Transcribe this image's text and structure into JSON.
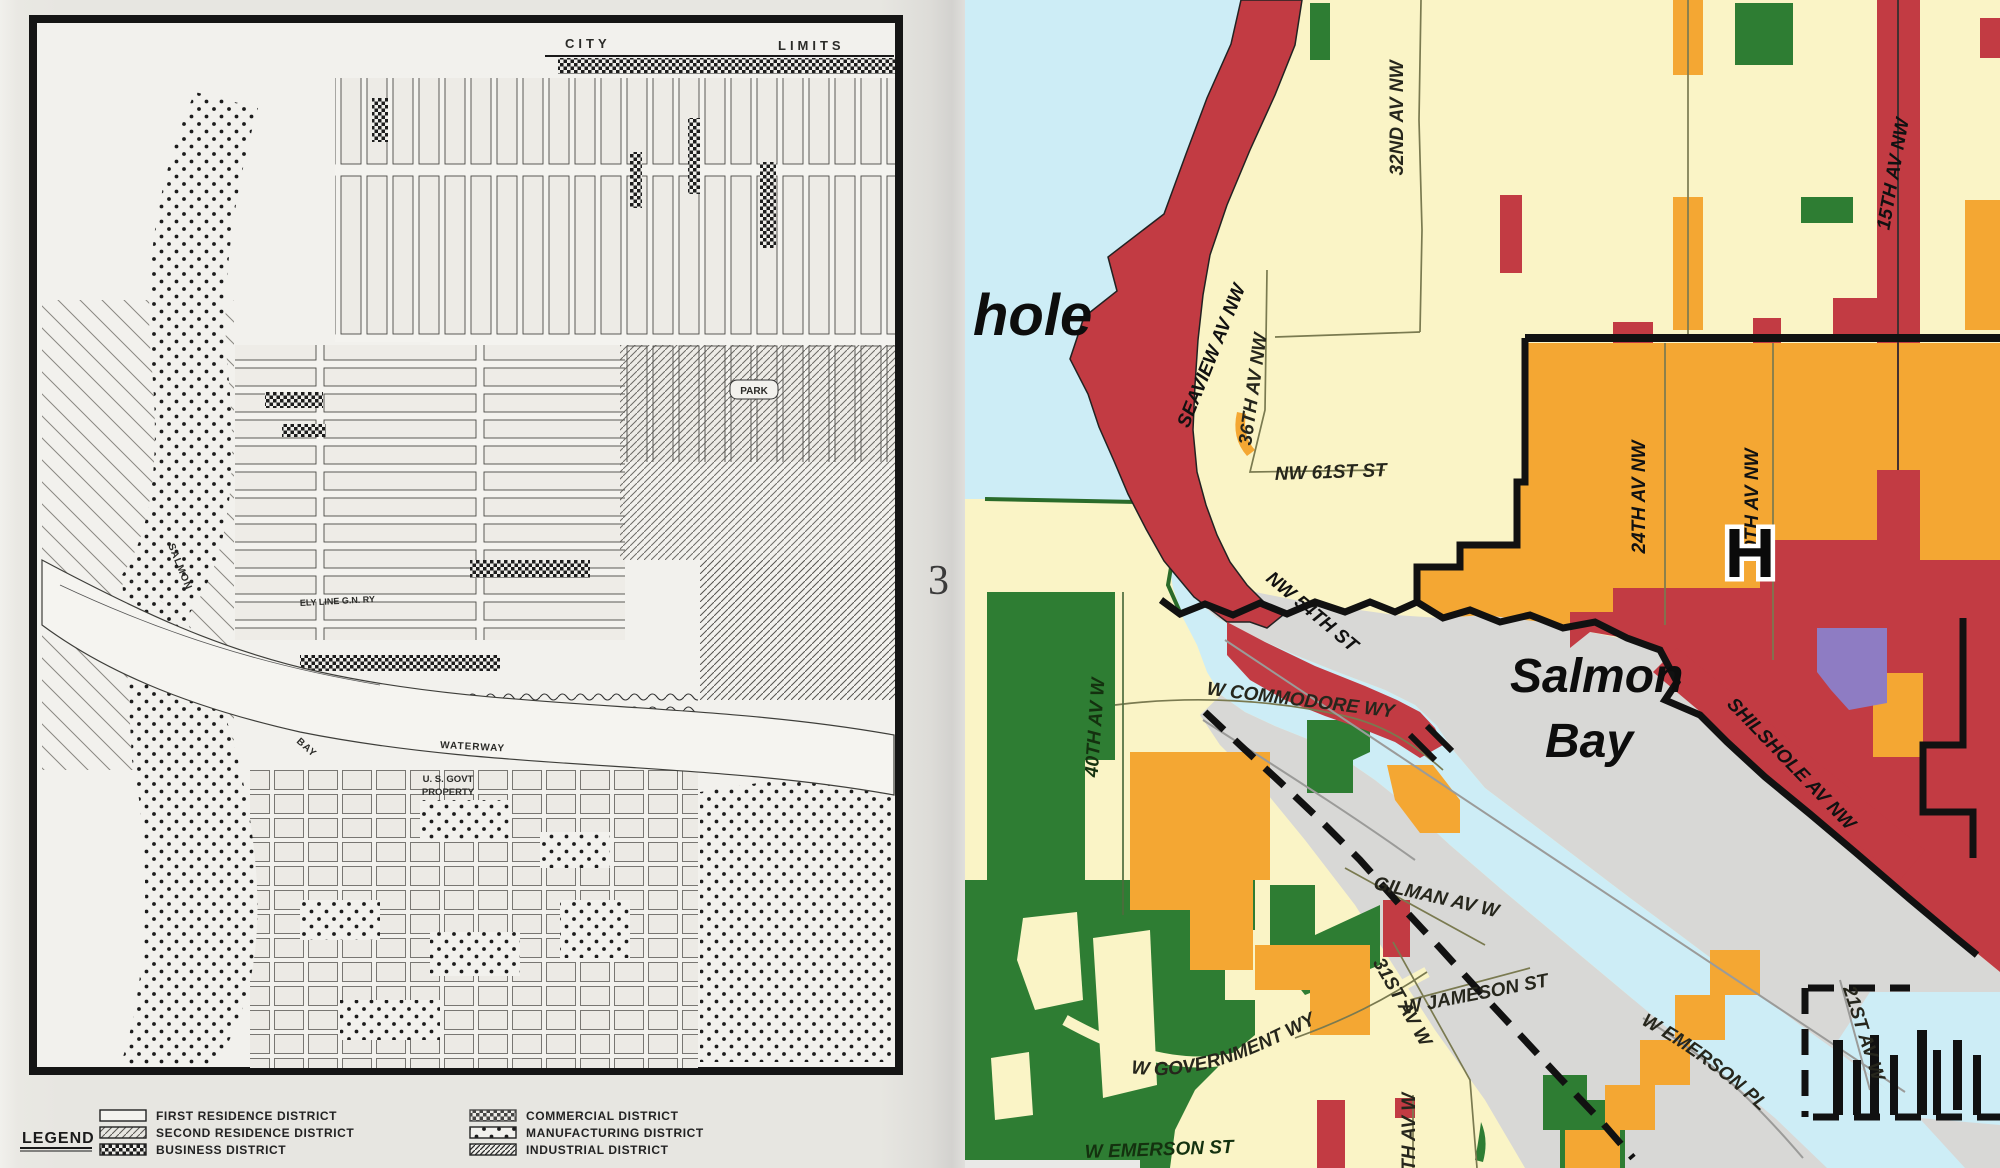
{
  "left_map": {
    "region_labels": {
      "city": "CITY",
      "limits": "LIMITS",
      "salmon": "SALMON",
      "bay": "BAY",
      "waterway": "WATERWAY",
      "govt_line1": "U. S. GOVT",
      "govt_line2": "PROPERTY",
      "railway": "ELY LINE G.N. RY",
      "park": "PARK"
    },
    "legend": {
      "title": "LEGEND",
      "items": [
        {
          "label": "FIRST RESIDENCE DISTRICT",
          "swatch": "empty"
        },
        {
          "label": "SECOND RESIDENCE DISTRICT",
          "swatch": "hatch-fine"
        },
        {
          "label": "BUSINESS DISTRICT",
          "swatch": "checker-dark"
        },
        {
          "label": "COMMERCIAL DISTRICT",
          "swatch": "checker"
        },
        {
          "label": "MANUFACTURING DISTRICT",
          "swatch": "dots"
        },
        {
          "label": "INDUSTRIAL DISTRICT",
          "swatch": "hatch-dense"
        }
      ]
    }
  },
  "page_number": "3",
  "right_map": {
    "streets": [
      {
        "name": "SEAVIEW AV NW"
      },
      {
        "name": "32ND AV NW"
      },
      {
        "name": "36TH AV NW"
      },
      {
        "name": "NW 61ST ST"
      },
      {
        "name": "NW 54TH ST"
      },
      {
        "name": "24TH AV NW"
      },
      {
        "name": "20TH AV NW"
      },
      {
        "name": "15TH AV NW"
      },
      {
        "name": "SHILSHOLE AV NW"
      },
      {
        "name": "W COMMODORE WY"
      },
      {
        "name": "40TH AV W"
      },
      {
        "name": "GILMAN AV W"
      },
      {
        "name": "W JAMESON ST"
      },
      {
        "name": "W GOVERNMENT WY"
      },
      {
        "name": "31ST AV W"
      },
      {
        "name": "34TH AV W"
      },
      {
        "name": "W EMERSON ST"
      },
      {
        "name": "W EMERSON PL"
      },
      {
        "name": "21ST AV W"
      }
    ],
    "places": {
      "shilshole_partial": "hole",
      "salmon": "Salmon",
      "bay": "Bay"
    },
    "hospital_symbol": "H",
    "zone_colors": {
      "water": "#cdedf6",
      "single_family_cream": "#faf4c6",
      "multifamily_orange": "#f4a733",
      "commercial_red": "#c23b43",
      "parks_green": "#2e7d33",
      "industrial_gray": "#d8d8d6",
      "major_institution_purple": "#8e7cc3"
    }
  }
}
